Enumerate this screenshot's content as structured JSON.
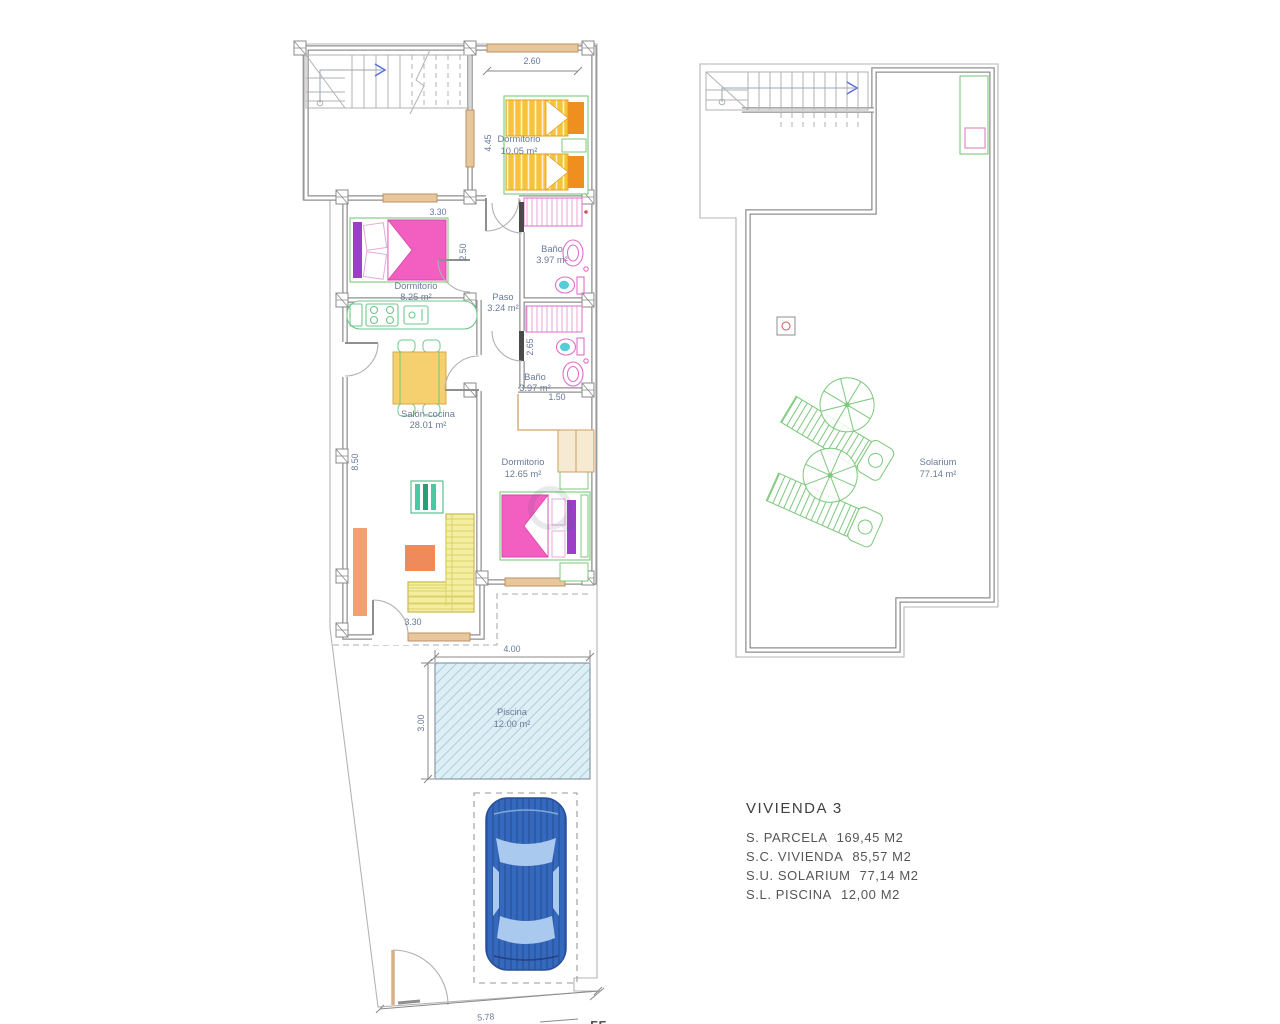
{
  "plan": {
    "ground_floor": {
      "rooms": {
        "dormitorio1": {
          "name": "Dormitorio",
          "area": "10.05 m²"
        },
        "dormitorio2": {
          "name": "Dormitorio",
          "area": "8.25 m²"
        },
        "bano1": {
          "name": "Baño",
          "area": "3.97 m²"
        },
        "paso": {
          "name": "Paso",
          "area": "3.24 m²"
        },
        "bano2": {
          "name": "Baño",
          "area": "3.97 m²"
        },
        "salon": {
          "name": "Salón-cocina",
          "area": "28.01 m²"
        },
        "dormitorio3": {
          "name": "Dormitorio",
          "area": "12.65 m²"
        },
        "piscina": {
          "name": "Piscina",
          "area": "12.00 m²"
        }
      },
      "dimensions": {
        "bedroom1_width": "2.60",
        "bedroom1_depth": "4.45",
        "bedroom2_width": "3.30",
        "bedroom2_depth": "2.50",
        "bath_depth": "2.65",
        "hall_opening": "1.50",
        "salon_depth": "8.50",
        "salon_door": "3.30",
        "pool_width": "4.00",
        "pool_depth": "3.00",
        "plot_front": "5.78",
        "bottom_edge_partial": "55"
      }
    },
    "solarium": {
      "name": "Solarium",
      "area": "77.14 m²"
    },
    "legend": {
      "title": "VIVIENDA 3",
      "items": [
        {
          "label": "S. PARCELA",
          "value": "169,45 M2"
        },
        {
          "label": "S.C. VIVIENDA",
          "value": "85,57 M2"
        },
        {
          "label": "S.U. SOLARIUM",
          "value": "77,14 M2"
        },
        {
          "label": "S.L. PISCINA",
          "value": "12,00 M2"
        }
      ]
    },
    "colors": {
      "wall_gray": "#8f8f8f",
      "label_blue": "#6a7a99",
      "bed_yellow": "#f6c43a",
      "pillow_orange": "#ef8f1f",
      "bed_pink": "#f25fc0",
      "wardrobe_purple": "#9b3fc9",
      "furniture_green": "#6cc98c",
      "sofa_yellow": "#f4efa0",
      "table_orange": "#ef8a5a",
      "fixture_pink": "#df6ec8",
      "toilet_cyan": "#55cdd8",
      "window_tan": "#e7c79b",
      "pool_cyan": "#ddeef5",
      "car_blue": "#3569bd",
      "solarium_green": "#7cc87c"
    }
  }
}
